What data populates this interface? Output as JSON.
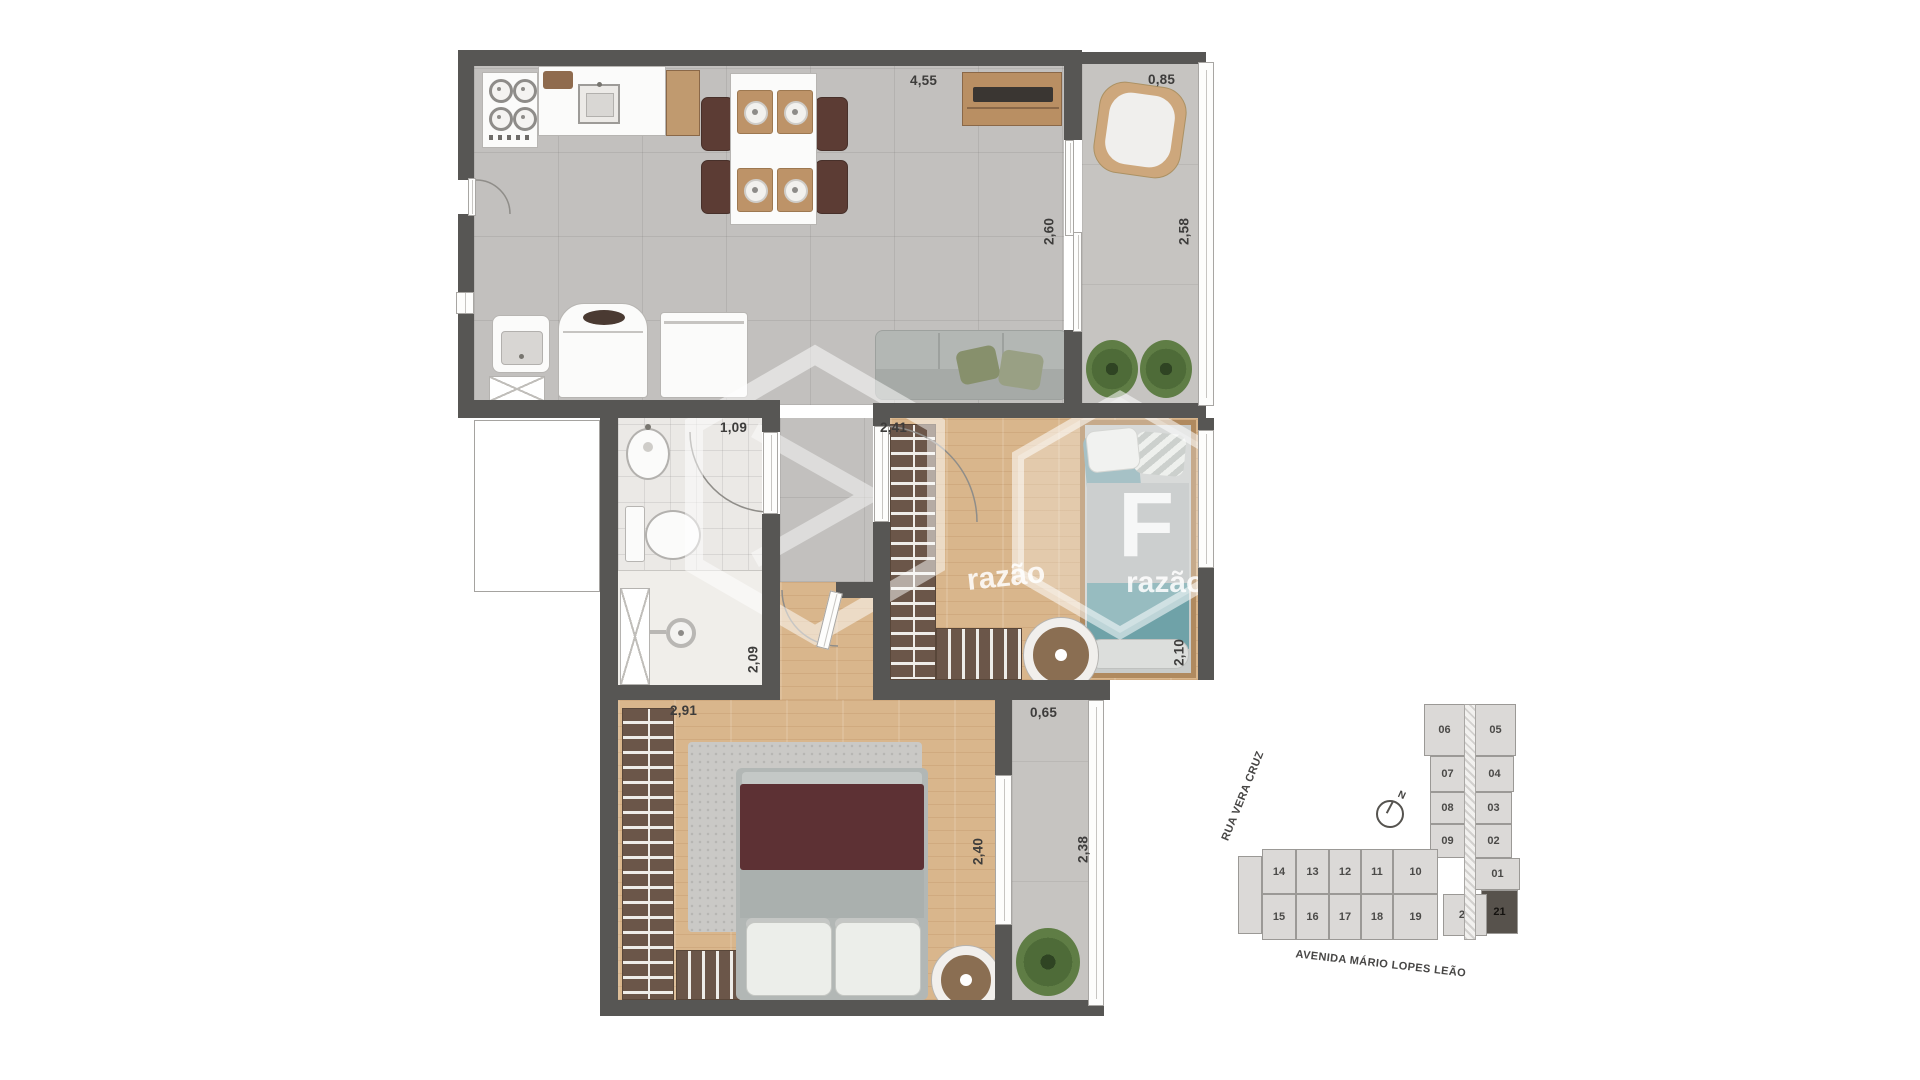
{
  "watermark": {
    "brand_letter": "F",
    "brand_word": "razão"
  },
  "floor_plan": {
    "dimensions": {
      "living_width": "4,55",
      "balcony_top_width": "0,85",
      "living_depth": "2,60",
      "balcony_top_depth": "2,58",
      "bathroom_width": "1,09",
      "bedroom2_width": "2,41",
      "bathroom_depth": "2,09",
      "bedroom2_depth": "2,10",
      "bedroom1_width": "2,91",
      "service_width": "0,65",
      "bedroom1_depth": "2,40",
      "bedroom1_balcony_depth": "2,38"
    }
  },
  "key_plan": {
    "north_label": "N",
    "street_left": "RUA VERA CRUZ",
    "street_bottom": "AVENIDA MÁRIO LOPES LEÃO",
    "tower_rows": [
      [
        "06",
        "05"
      ],
      [
        "07",
        "04"
      ],
      [
        "08",
        "03"
      ],
      [
        "09",
        "02"
      ]
    ],
    "unit_01": "01",
    "unit_21": "21",
    "wing_top": [
      "14",
      "13",
      "12",
      "11",
      "10"
    ],
    "wing_bottom": [
      "15",
      "16",
      "17",
      "18",
      "19",
      "20"
    ],
    "highlight_color": "#57524c"
  },
  "colors": {
    "wall": "#575654",
    "tile_floor": "#c2c0be",
    "wood_floor": "#d9b68c",
    "bath_tile": "#ebe9e6",
    "master_blanket": "#5d3134",
    "single_bed_blanket": "#84aab0",
    "wardrobe": "#6b5649",
    "keyplan_block": "#dbd9d7",
    "keyplan_highlight": "#57524c"
  }
}
